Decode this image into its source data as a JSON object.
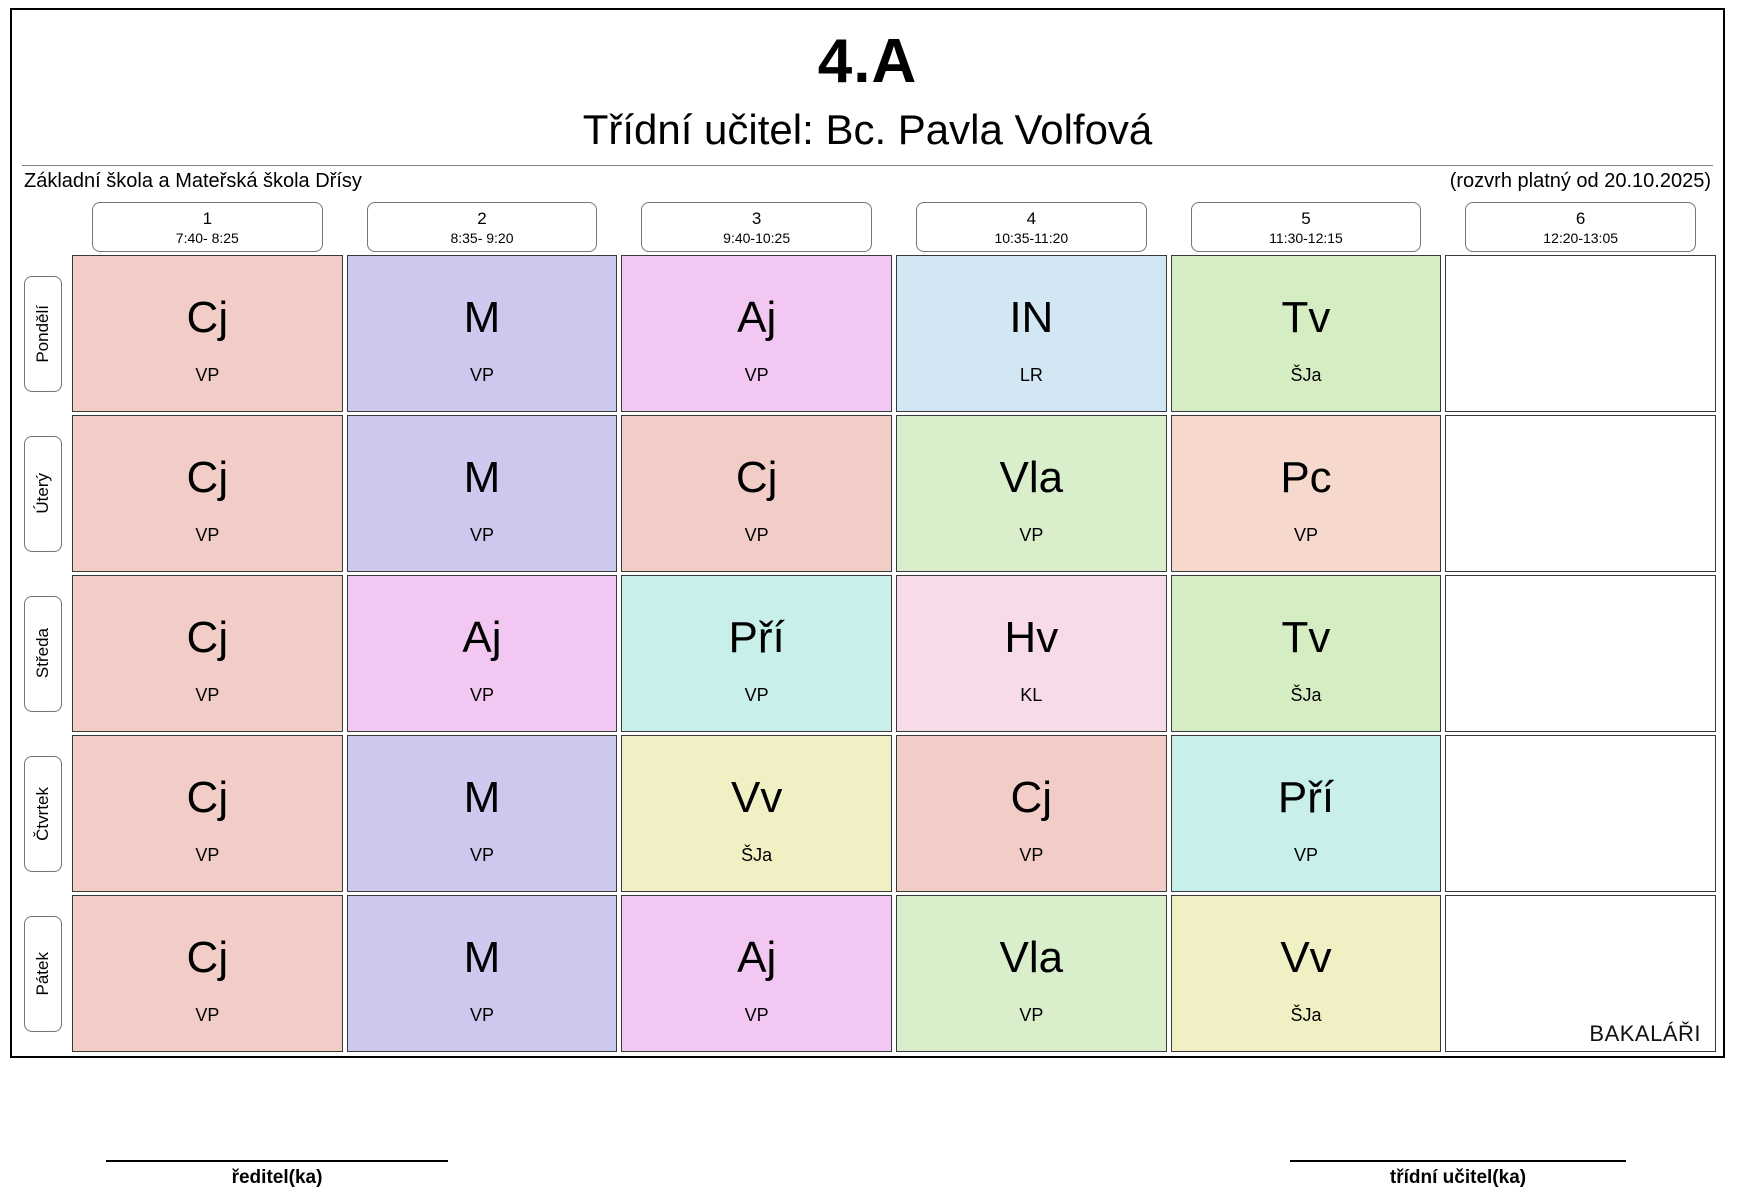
{
  "header": {
    "class_name": "4.A",
    "subtitle": "Třídní učitel: Bc. Pavla Volfová",
    "school": "Základní škola a Mateřská škola Dřísy",
    "validity": "(rozvrh platný od 20.10.2025)"
  },
  "periods": [
    {
      "num": "1",
      "time": "7:40- 8:25"
    },
    {
      "num": "2",
      "time": "8:35- 9:20"
    },
    {
      "num": "3",
      "time": "9:40-10:25"
    },
    {
      "num": "4",
      "time": "10:35-11:20"
    },
    {
      "num": "5",
      "time": "11:30-12:15"
    },
    {
      "num": "6",
      "time": "12:20-13:05"
    }
  ],
  "days": [
    "Pondělí",
    "Úterý",
    "Středa",
    "Čtvrtek",
    "Pátek"
  ],
  "subject_colors": {
    "Cj": "#f2cdc8",
    "M": "#cdc8ee",
    "Aj": "#f2c7f2",
    "IN": "#d2e7f3",
    "Tv": "#d5edc3",
    "Vla": "#d9efcc",
    "Pc": "#f6d8cd",
    "Pří": "#c8efe9",
    "Hv": "#f7dbe9",
    "Vv": "#f1efc4"
  },
  "timetable": [
    [
      {
        "subject": "Cj",
        "teacher": "VP"
      },
      {
        "subject": "M",
        "teacher": "VP"
      },
      {
        "subject": "Aj",
        "teacher": "VP"
      },
      {
        "subject": "IN",
        "teacher": "LR"
      },
      {
        "subject": "Tv",
        "teacher": "ŠJa"
      },
      null
    ],
    [
      {
        "subject": "Cj",
        "teacher": "VP"
      },
      {
        "subject": "M",
        "teacher": "VP"
      },
      {
        "subject": "Cj",
        "teacher": "VP"
      },
      {
        "subject": "Vla",
        "teacher": "VP"
      },
      {
        "subject": "Pc",
        "teacher": "VP"
      },
      null
    ],
    [
      {
        "subject": "Cj",
        "teacher": "VP"
      },
      {
        "subject": "Aj",
        "teacher": "VP"
      },
      {
        "subject": "Pří",
        "teacher": "VP"
      },
      {
        "subject": "Hv",
        "teacher": "KL"
      },
      {
        "subject": "Tv",
        "teacher": "ŠJa"
      },
      null
    ],
    [
      {
        "subject": "Cj",
        "teacher": "VP"
      },
      {
        "subject": "M",
        "teacher": "VP"
      },
      {
        "subject": "Vv",
        "teacher": "ŠJa"
      },
      {
        "subject": "Cj",
        "teacher": "VP"
      },
      {
        "subject": "Pří",
        "teacher": "VP"
      },
      null
    ],
    [
      {
        "subject": "Cj",
        "teacher": "VP"
      },
      {
        "subject": "M",
        "teacher": "VP"
      },
      {
        "subject": "Aj",
        "teacher": "VP"
      },
      {
        "subject": "Vla",
        "teacher": "VP"
      },
      {
        "subject": "Vv",
        "teacher": "ŠJa"
      },
      null
    ]
  ],
  "footer": {
    "director_label": "ředitel(ka)",
    "class_teacher_label": "třídní učitel(ka)"
  },
  "logo": {
    "text": "BAKALÁŘI",
    "letter": "B"
  }
}
